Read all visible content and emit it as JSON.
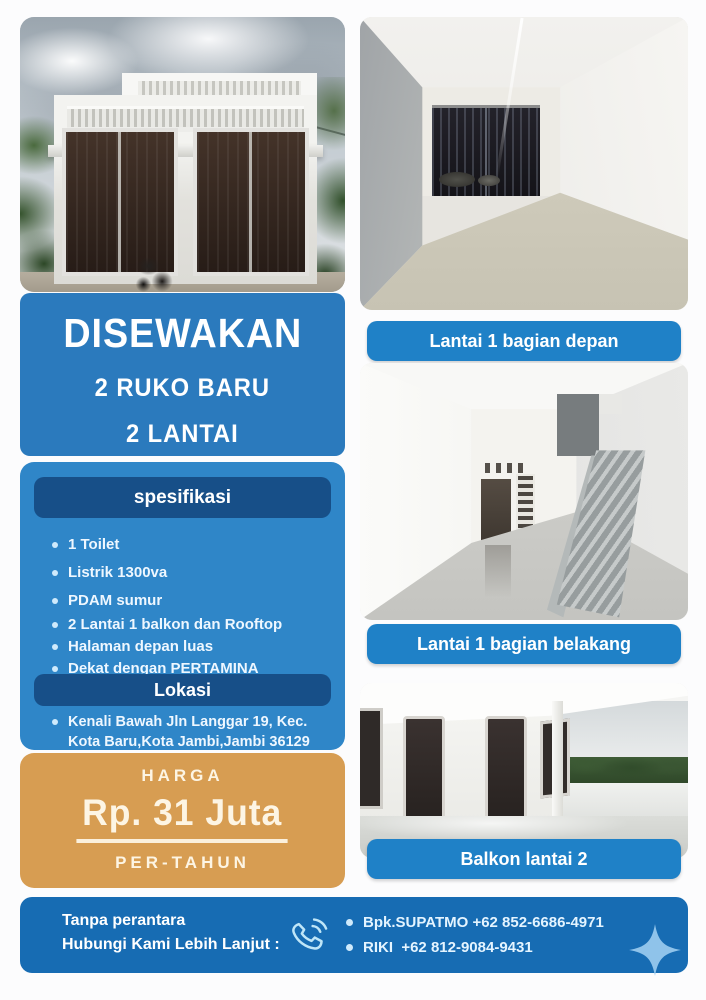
{
  "colors": {
    "blue_title_box": "#2b7abd",
    "blue_spec_panel": "#2f86c8",
    "blue_header_pill": "#174f88",
    "blue_caption": "#1f81c7",
    "blue_contact_bar": "#176cb3",
    "orange_price_box": "#d79d52",
    "accent_light_blue": "#bfe6f8",
    "sparkle_blue": "#8fc3ea",
    "text_white": "#ffffff"
  },
  "title": {
    "line1": "DISEWAKAN",
    "line2": "2 RUKO BARU",
    "line3": "2 LANTAI"
  },
  "spec": {
    "header": "spesifikasi",
    "items": [
      "1 Toilet",
      "Listrik 1300va",
      "PDAM sumur",
      "2 Lantai 1 balkon dan Rooftop",
      "Halaman depan luas",
      "Dekat dengan PERTAMINA"
    ]
  },
  "location": {
    "header": "Lokasi",
    "address_line1": "Kenali Bawah Jln Langgar 19, Kec.",
    "address_line2": "Kota Baru,Kota Jambi,Jambi 36129"
  },
  "price": {
    "label": "HARGA",
    "value": "Rp. 31 Juta",
    "period": "PER-TAHUN"
  },
  "photos": {
    "captions": [
      "Lantai 1 bagian depan",
      "Lantai 1 bagian belakang",
      "Balkon lantai 2"
    ]
  },
  "contact": {
    "line1": "Tanpa perantara",
    "line2": "Hubungi Kami Lebih Lanjut :",
    "entries": [
      "Bpk.SUPATMO +62 852-6686-4971",
      "RIKI  +62 812-9084-9431"
    ]
  },
  "icons": {
    "phone-icon": "✆",
    "sparkle-icon": "✦",
    "bullet-dot": "•"
  }
}
